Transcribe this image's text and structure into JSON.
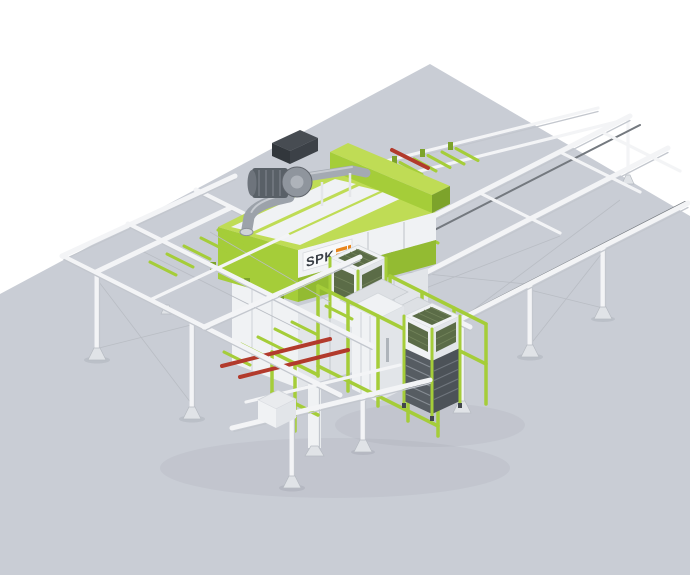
{
  "machine": {
    "brand_label": "SPK"
  },
  "colors": {
    "background": "#ffffff",
    "floor": "#c9cdd5",
    "green": "#a5cd39",
    "green_light": "#bfdc55",
    "green_mid": "#93bb32",
    "green_dark": "#7da32b",
    "panel": "#f0f2f4",
    "panel_shade": "#e2e5e9",
    "rail": "#f3f4f6",
    "rail_edge": "#c3c7ce",
    "track": "#74797f",
    "steel": "#9aa0a8",
    "steel_light": "#c6cad0",
    "dark": "#42474d",
    "louver": "#565c62",
    "mesh": "#5b6c47",
    "red": "#b23a2c",
    "orange": "#e8851d",
    "logo_ink": "#3a3f46"
  }
}
